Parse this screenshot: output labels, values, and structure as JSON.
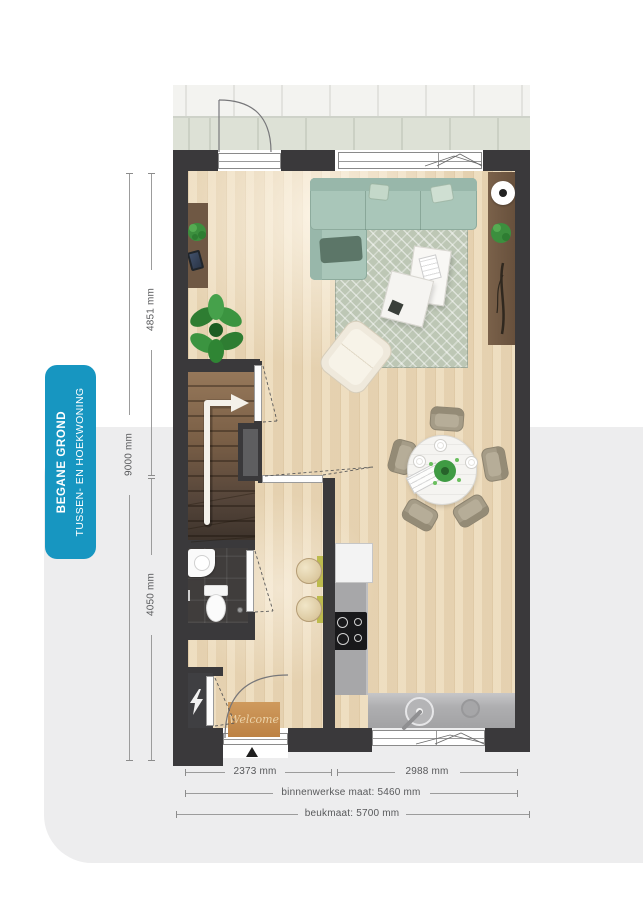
{
  "page": {
    "background": "#ffffff",
    "panel_color": "#ededee"
  },
  "side_tag": {
    "line1": "BEGANE GROND",
    "line2": "TUSSEN- EN HOEKWONING",
    "bg_color": "#1796c1",
    "text_color": "#ffffff"
  },
  "dimensions": {
    "left_total": {
      "label": "9000 mm"
    },
    "left_upper": {
      "label": "4851 mm"
    },
    "left_lower": {
      "label": "4050 mm"
    },
    "bottom_row1_left": {
      "label": "2373 mm"
    },
    "bottom_row1_right": {
      "label": "2988 mm"
    },
    "bottom_row2": {
      "label": "binnenwerkse maat: 5460 mm"
    },
    "bottom_row3": {
      "label": "beukmaat: 5700 mm"
    }
  },
  "floor_plan": {
    "entrance_mat_text": "Welcome",
    "icons": {
      "meter_cupboard": "lightning-bolt-icon",
      "stairs_direction": "up-arrow-icon",
      "entrance_marker": "triangle-up-icon"
    },
    "colors": {
      "walls": "#3a393b",
      "wood_floor": "#ecd9b8",
      "terrace_tile_top": "#f3f3f0",
      "terrace_tile_bottom": "#dde1d6",
      "sofa": "#a9c6b9",
      "rug": "#bdc7b5",
      "kitchen_counter": "#a8a8aa",
      "stairs": "#6b5440",
      "welcome_mat": "#c6914f",
      "dim_text": "#58595b"
    }
  }
}
